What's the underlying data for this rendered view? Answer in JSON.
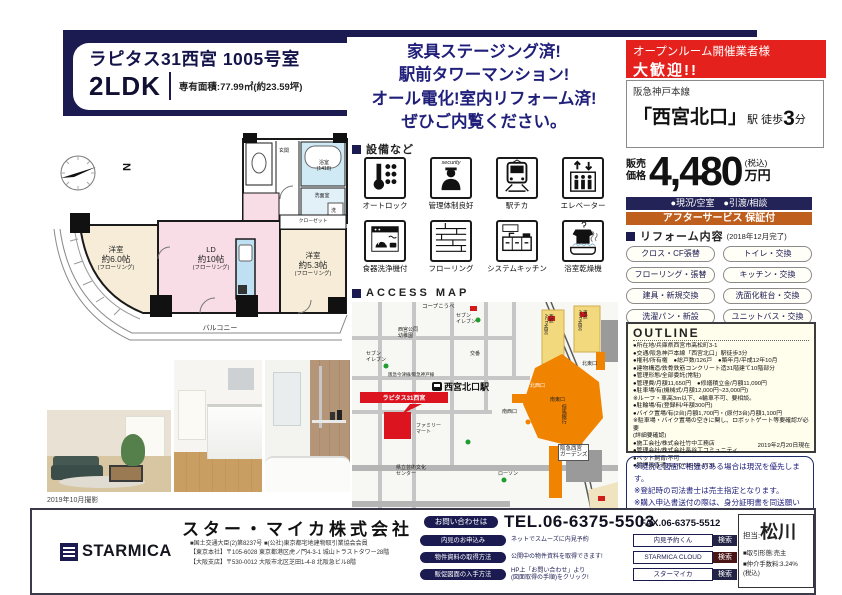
{
  "header": {
    "title": "ラピタス31西宮 1005号室",
    "layout": "2LDK",
    "area": "専有面積:77.99㎡(約23.59坪)",
    "catch": "家具ステージング済!\n駅前タワーマンション!\nオール電化!室内リフォーム済!\nぜひご内覧ください。"
  },
  "offer": {
    "openroom1": "オープンルーム開催業者様",
    "openroom2": "大歓迎!!",
    "railway": "阪急神戸本線",
    "station_big": "「西宮北口」",
    "station_mid": "駅 徒歩",
    "station_num": "3",
    "station_unit": "分",
    "price_label": "販売\n価格",
    "price": "4,480",
    "price_tax": "(税込)",
    "price_unit": "万円",
    "status": "●現況/空室　●引渡/相談",
    "after_service": "アフターサービス 保証付"
  },
  "reform": {
    "heading": "リフォーム内容",
    "date": "(2018年12月完了)",
    "items": [
      "クロス・CF張替",
      "トイレ・交換",
      "フローリング・張替",
      "キッチン・交換",
      "建具・新規交換",
      "洗面化粧台・交換",
      "洗濯パン・新設",
      "ユニットバス・交換"
    ]
  },
  "outline": {
    "heading": "OUTLINE",
    "lines": [
      "●所在地/兵庫県西宮市高松町3-1",
      "●交通/阪急神戸本線「西宮北口」駅徒歩3分",
      "●権利/所有権　●総戸数/126戸　●築年月/平成12年10月",
      "●建物構造/鉄骨鉄筋コンクリート造31階建て10階部分",
      "●管理形態/全部委託(常駐)",
      "●管理費/月額11,650円　●修繕積立金/月額11,090円",
      "●駐車場/有(機械式/月額12,000円~23,000円)",
      "※ルーフ・車高3m以下、4輪車不可、要相談。",
      "●駐輪場/有(登録料/年額300円)",
      "●バイク置場/有(2台)月額1,700円・(原付3台)月額1,100円",
      "※駐車場・バイク置場の空きに関し、ロボットゲート等要確認が必要",
      "(詳細要確認)",
      "●施工会社/株式会社竹中工務店",
      "●管理会社/株式会社長谷工コミュニティ",
      "●ペット飼育/不可",
      "●管理員直通TEL/0798-64-1731"
    ],
    "asof": "2019年2月20日現在"
  },
  "warnings": "※現況と図面に相違のある場合は現況を優先します。\n※登記時の司法書士は売主指定となります。\n※購入申込書送付の際は、身分証明書を同送願います。",
  "equipment": {
    "heading": "設備など",
    "security_badge": "security",
    "items": [
      "オートロック",
      "管理体制良好",
      "駅チカ",
      "エレベーター",
      "食器洗浄機付",
      "フローリング",
      "システムキッチン",
      "浴室乾燥機"
    ]
  },
  "floorplan": {
    "compass": "N",
    "bedroom1_name": "洋室",
    "bedroom1_size": "約6.0帖",
    "bedroom1_floor": "(フローリング)",
    "ld_name": "LD",
    "ld_size": "約10帖",
    "ld_floor": "(フローリング)",
    "bedroom2_name": "洋室",
    "bedroom2_size": "約5.3帖",
    "bedroom2_floor": "(フローリング)",
    "bath": "浴室\n(1418)",
    "washroom": "洗面室",
    "washer": "洗",
    "entrance": "玄関",
    "closet": "クローゼット",
    "balcony": "バルコニー",
    "photo_caption": "2019年10月撮影"
  },
  "map": {
    "heading": "ACCESS MAP",
    "coop": "コープこうべ",
    "seven1": "セブン\nイレブン",
    "kindergarten": "西宮公同\n幼稚園",
    "koban": "交番",
    "rails": "阪急今津線/阪急神戸線",
    "station": "西宮北口駅",
    "exit_nw": "北西口",
    "exit_ne": "北東口",
    "exit_sw": "南西口",
    "exit_se": "南東口",
    "acta_w": "西館\nACTA西宮",
    "acta_e": "東館\nACTA西宮",
    "seven2": "セブン\nイレブン",
    "famima": "ファミリー\nマート",
    "tajima": "但馬銀行",
    "gardens": "阪急西宮\nガーデンズ",
    "artcenter": "県立芸術文化\nセンター",
    "lawson": "ローソン",
    "property": "ラピタス31西宮",
    "note": "※鍵は現地対応。案内方法は「内見予約くん」よりご確認下さい。"
  },
  "footer": {
    "company": "スター・マイカ株式会社",
    "brand": "STARMICA",
    "license": "■国土交通大臣(2)第8237号 ■(公社)東京都宅地建物取引業協会会員\n【東京本社】〒105-6028 東京都港区虎ノ門4-3-1 城山トラストタワー28階\n【大阪支店】〒530-0012 大阪市北区芝田1-4-8 北阪急ビル8階",
    "contact_label": "お問い合わせは",
    "tel": "TEL.06-6375-5503",
    "fax": "FAX.06-6375-5512",
    "rows": [
      {
        "label": "内見のお申込み",
        "desc": "ネットでスムーズに内見予約",
        "query": "内見予約くん",
        "btn": "検索"
      },
      {
        "label": "物件資料の取得方法",
        "desc": "公開中の物件資料を取得できます!",
        "query": "STARMICA CLOUD",
        "btn": "検索"
      },
      {
        "label": "販促図面の入手方法",
        "desc": "HP上「お問い合わせ」より\n(図面取得の手順)をクリック!",
        "query": "スターマイカ",
        "btn": "検索"
      }
    ],
    "agent_label": "担当:",
    "agent_name": "松川",
    "agent_deal": "■取引形態:売主",
    "agent_fee": "■仲介手数料:3.24%\n(税込)"
  }
}
